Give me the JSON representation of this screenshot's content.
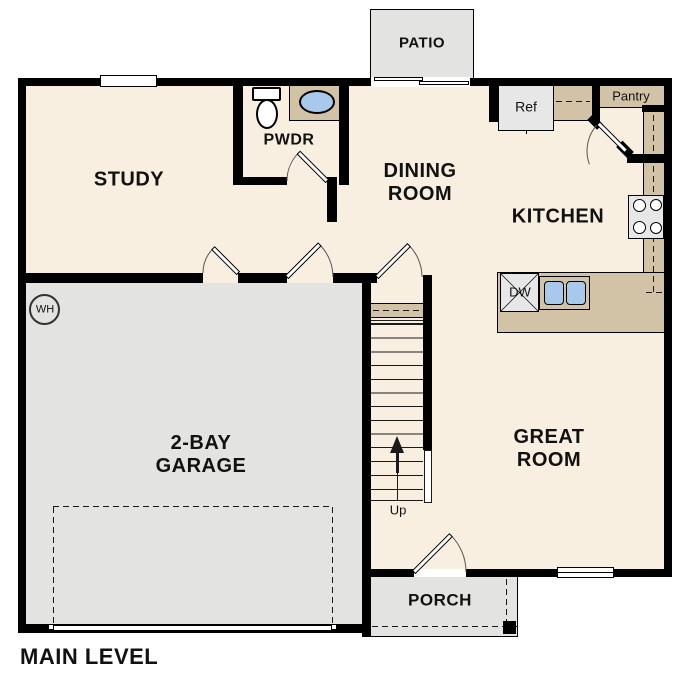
{
  "colors": {
    "wall": "#000000",
    "line": "#1a1a1a",
    "floor": "#f8efe0",
    "garage": "#e3e3e1",
    "counter": "#d3c3a6",
    "sink": "#a9c9ec",
    "appliance": "#e7e7e7"
  },
  "plan": {
    "title": "MAIN LEVEL",
    "rooms": {
      "study": "STUDY",
      "pwdr": "PWDR",
      "dining": "DINING\nROOM",
      "kitchen": "KITCHEN",
      "great": "GREAT\nROOM",
      "garage": "2-BAY\nGARAGE",
      "patio": "PATIO",
      "porch": "PORCH"
    },
    "fixtures": {
      "ref": "Ref",
      "pantry": "Pantry",
      "dw": "DW",
      "up": "Up",
      "wh": "WH"
    }
  }
}
